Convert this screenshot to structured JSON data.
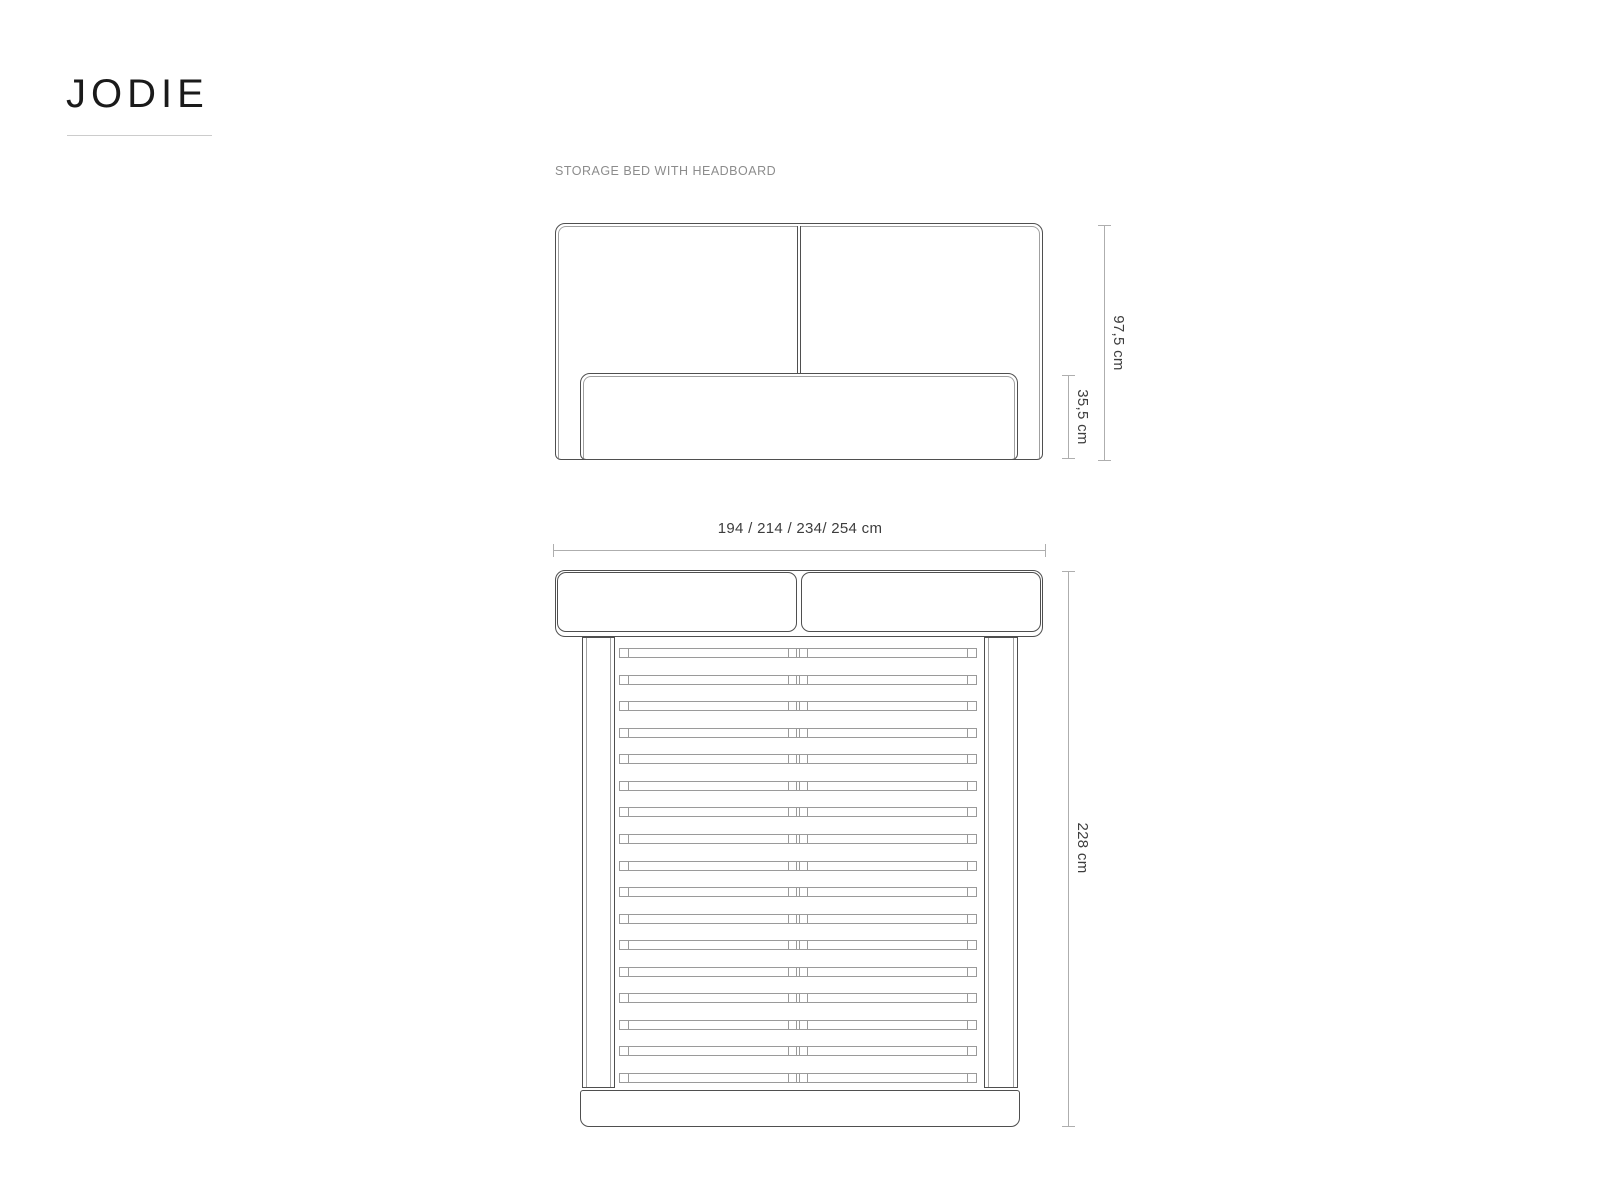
{
  "colors": {
    "ink": "#4f4f4f",
    "line_light": "#9a9a9a",
    "dim_line": "#aeaeae",
    "dim_text": "#3d3d3d",
    "muted_text": "#8c8c8c",
    "brand_text": "#1a1a1a",
    "underline": "#cccccc"
  },
  "brand": {
    "name": "JODIE"
  },
  "figure": {
    "subtitle": "STORAGE BED WITH HEADBOARD",
    "front_view": {
      "dim_total_height": "97,5 cm",
      "dim_frame_height": "35,5 cm"
    },
    "top_view": {
      "dim_width": "194 / 214 / 234/ 254 cm",
      "dim_length": "228 cm",
      "slat_count": 17
    }
  }
}
